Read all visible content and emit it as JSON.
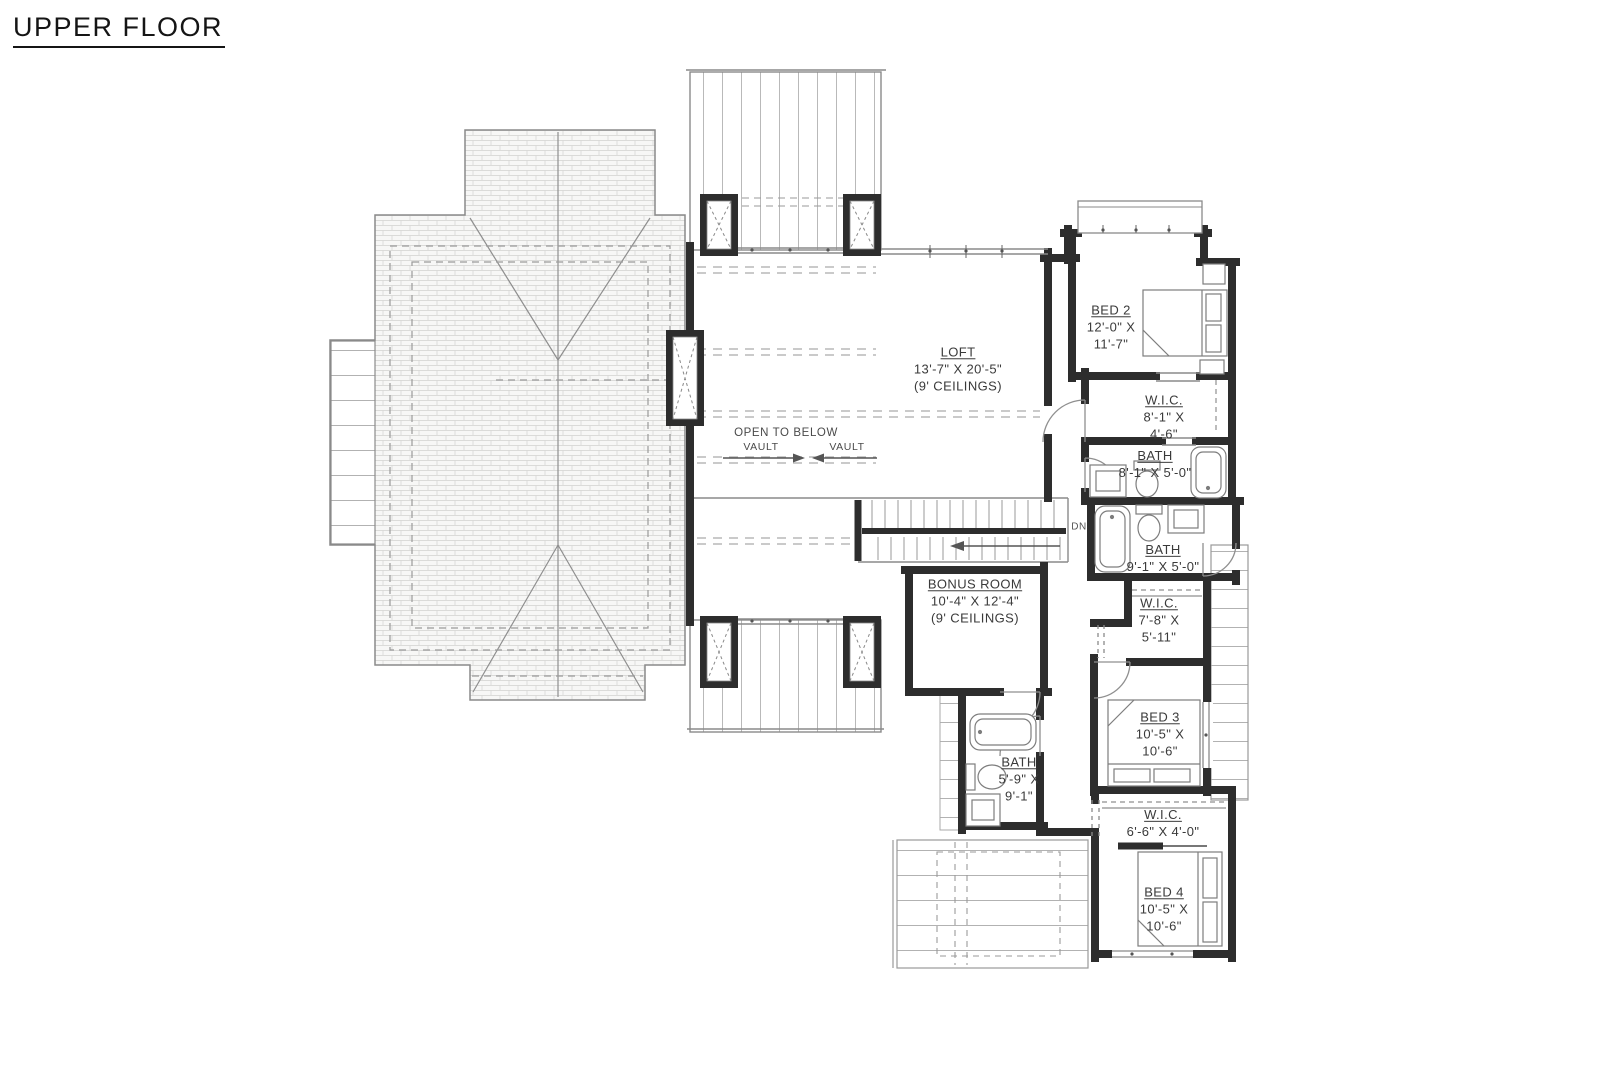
{
  "title": "UPPER FLOOR",
  "rooms": {
    "loft": {
      "name": "LOFT",
      "dim1": "13'-7\" X 20'-5\"",
      "dim2": "(9' CEILINGS)"
    },
    "bed2": {
      "name": "BED 2",
      "dim1": "12'-0\" X",
      "dim2": "11'-7\""
    },
    "wic2": {
      "name": "W.I.C.",
      "dim1": "8'-1\" X",
      "dim2": "4'-6\""
    },
    "bath2": {
      "name": "BATH",
      "dim1": "8'-1\" X 5'-0\""
    },
    "bath3": {
      "name": "BATH",
      "dim1": "9'-1\" X 5'-0\""
    },
    "wic3": {
      "name": "W.I.C.",
      "dim1": "7'-8\" X",
      "dim2": "5'-11\""
    },
    "bonus": {
      "name": "BONUS ROOM",
      "dim1": "10'-4\" X 12'-4\"",
      "dim2": "(9' CEILINGS)"
    },
    "bed3": {
      "name": "BED 3",
      "dim1": "10'-5\" X",
      "dim2": "10'-6\""
    },
    "bath4": {
      "name": "BATH",
      "dim1": "5'-9\" X",
      "dim2": "9'-1\""
    },
    "wic4": {
      "name": "W.I.C.",
      "dim1": "6'-6\" X 4'-0\""
    },
    "bed4": {
      "name": "BED 4",
      "dim1": "10'-5\" X",
      "dim2": "10'-6\""
    }
  },
  "annotations": {
    "open_to_below": "OPEN TO BELOW",
    "vault_left": "VAULT",
    "vault_right": "VAULT",
    "down": "DN"
  },
  "colors": {
    "wall": "#2d2d2d",
    "line": "#8a8a8a",
    "dash": "#9a9a9a",
    "text": "#3a3a3a",
    "roof_line": "#c9c9c9"
  }
}
